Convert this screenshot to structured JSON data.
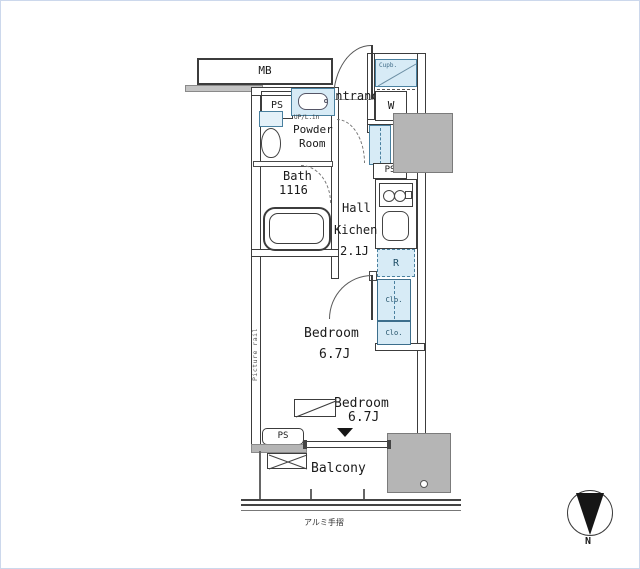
{
  "title": "apartment-floor-plan",
  "colors": {
    "wall": "#3c3c3c",
    "pillar_fill": "#b5b5b5",
    "fixture_fill": "#d7ebf6",
    "fixture_border": "#49809f",
    "text": "#1a1a1a",
    "frame": "#ccd8ec"
  },
  "labels": {
    "mb": "MB",
    "ps_top": "PS",
    "entrance": "Entrance",
    "cupboard": "Cupb.",
    "washer": "W",
    "powder_note": "UP/L.in",
    "powder1": "Powder",
    "powder2": "Room",
    "bath1": "Bath",
    "bath2": "1116",
    "hall": "Hall",
    "kitchen": "Kichen",
    "kitchen_size": "2.1J",
    "fridge": "R",
    "ps_mid": "PS",
    "closet1": "Clo.",
    "closet2": "Clo.",
    "picture_rail": "Picture rail",
    "bedroom1": "Bedroom",
    "bedroom1_size": "6.7J",
    "bedroom2": "Bedroom",
    "bedroom2_size": "6.7J",
    "ps_bottom": "PS",
    "balcony": "Balcony",
    "handrail": "アルミ手摺",
    "compass_n": "N"
  }
}
